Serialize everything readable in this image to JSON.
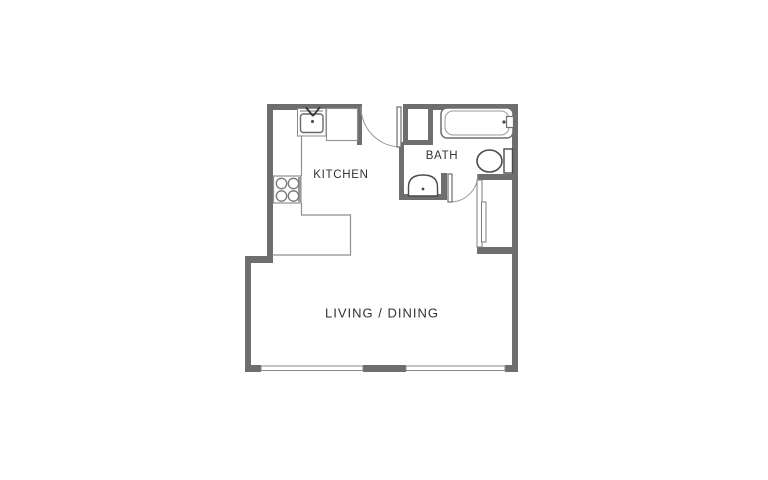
{
  "plan": {
    "title": "studio-apartment-floor-plan",
    "rooms": {
      "kitchen": "KITCHEN",
      "bath": "BATH",
      "living_dining": "LIVING / DINING"
    },
    "fixtures": [
      "kitchen-sink",
      "kitchen-counter",
      "stove-4-burner",
      "bathtub",
      "toilet",
      "bath-sink",
      "closet-sliding-doors",
      "entry-door",
      "bath-door",
      "window-left",
      "window-right",
      "wall-chase"
    ],
    "colors": {
      "background": "#ffffff",
      "wall": "#6e6e6e",
      "counter_line": "#8f8f8f",
      "fixture_outline": "#4a4a4a",
      "tub_outline": "#6f6f6f",
      "door_arc": "#9a9a9a",
      "label_text": "#323232"
    }
  }
}
